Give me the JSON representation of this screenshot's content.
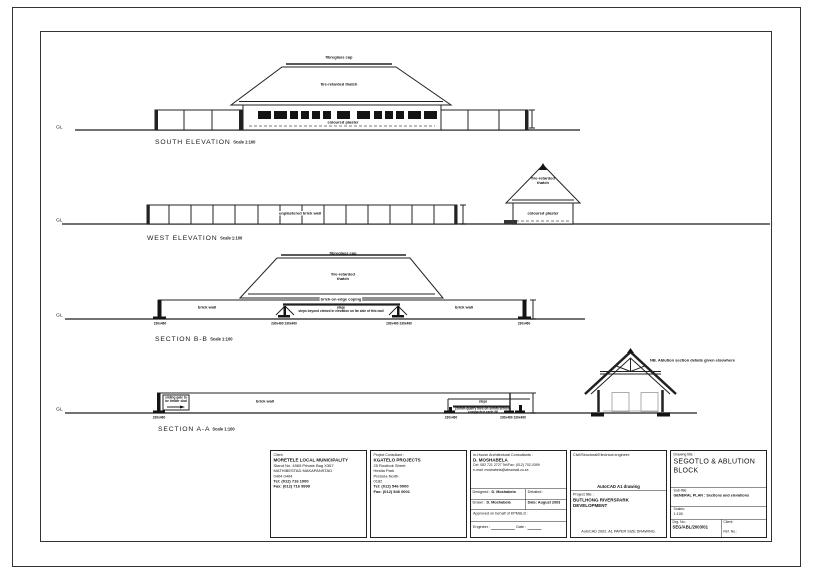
{
  "sheet": {
    "south": {
      "caption": "SOUTH ELEVATION",
      "scale": "Scale 1:100",
      "gl": "GL",
      "cap": "fibreglass cap",
      "thatch": "fire-retarded thatch",
      "plaster": "coloured plaster"
    },
    "west": {
      "caption": "WEST ELEVATION",
      "scale": "Scale 1:100",
      "gl": "GL",
      "wall": "unplastered brick wall",
      "thatch1": "fire-retarded",
      "thatch2": "thatch",
      "plaster": "coloured plaster"
    },
    "sectionB": {
      "caption": "SECTION B-B",
      "scale": "Scale 1:100",
      "gl": "GL",
      "cap": "fibreglass cap",
      "thatch1": "fire-retarded",
      "thatch2": "thatch",
      "coping": "brick-on-edge coping",
      "wall_left": "brick wall",
      "wall_right": "brick wall",
      "stage": "stage",
      "stage_note": "steps beyond viewed in elevation on far side of this wall",
      "col_left": "230x460",
      "col_right": "230x460",
      "col_mid_left": "230x460 230x460",
      "col_mid_right": "230x460 230x460"
    },
    "sectionA": {
      "caption": "SECTION A-A",
      "scale": "Scale 1:100",
      "gl": "GL",
      "gate1": "sliding gate to",
      "gate2": "be timber clad",
      "wall": "brick wall",
      "steps": "steps",
      "steps_note1": "(50mm quarry tiles on 30mm screed)",
      "steps_note2": "compacted earth fill",
      "col_left": "230x460",
      "col_mid": "230x460",
      "col_right": "230x460 230x460"
    },
    "gable": {
      "note": "NB. Ablution section details given elsewhere"
    },
    "title_block": {
      "client": {
        "label": "Client:",
        "name": "MORETELE LOCAL MUNICIPALITY",
        "addr1": "Stand No. 4965      Private Bag X367",
        "addr2": "MATHIBESTAD        MAKAPANSTAD",
        "addr3": "0404                      0404",
        "tel": "Tel: (012) 716 1000",
        "fax": "Fax: (012) 716 9999"
      },
      "consultant": {
        "label": "Project Consultant :",
        "name": "KGATELO PROJECTS",
        "addr1": "25 Rooibok Street",
        "addr2": "Hestia Park",
        "addr3": "Pretoria North",
        "addr4": "0182",
        "tel": "Tel: (012) 546 0000",
        "fax": "Fax: (012) 546 0001"
      },
      "architect": {
        "label": "In-House Architectural Consultants :",
        "name": "D. MOSHABELA",
        "contact": "Cel: 082 721 2727   Tel/Fax: (012) 702-0399",
        "email": "e-mail: moshabela@absamail.co.za",
        "designed_label": "Designed :",
        "designed": "D. Moshabela",
        "detailed_label": "Detailed :",
        "drawn_label": "Drawn :",
        "drawn": "D. Moshabela",
        "date": "Date: August 2003",
        "approved": "Approved on behalf of KPM&LD :",
        "engineer_label": "Engineer :",
        "date_label": "Date :"
      },
      "engineer_box": {
        "label": "Civil/Structural/Electrical engineer:",
        "autocad": "AutoCAD A1 drawing",
        "project_label": "Project title :",
        "project1": "BUTLHONG RIVERSPARK",
        "project2": "DEVELOPMENT",
        "footer": "AutoCAD 2002. A1 PAPER SIZE DRAWING."
      },
      "title_box": {
        "label": "Drawing title :",
        "title": "SEGOTLO & ABLUTION BLOCK",
        "subtitle_label": "Sub-title:",
        "subtitle": "GENERAL PLAN : Sections and elevations",
        "scales_label": "Scales:",
        "scales": "1:100",
        "drg_label": "Drg. No.:",
        "drg_no": "SEG/ABL/2003/01",
        "client_label": "Client:",
        "ref_label": "Ref. No.:"
      }
    }
  }
}
